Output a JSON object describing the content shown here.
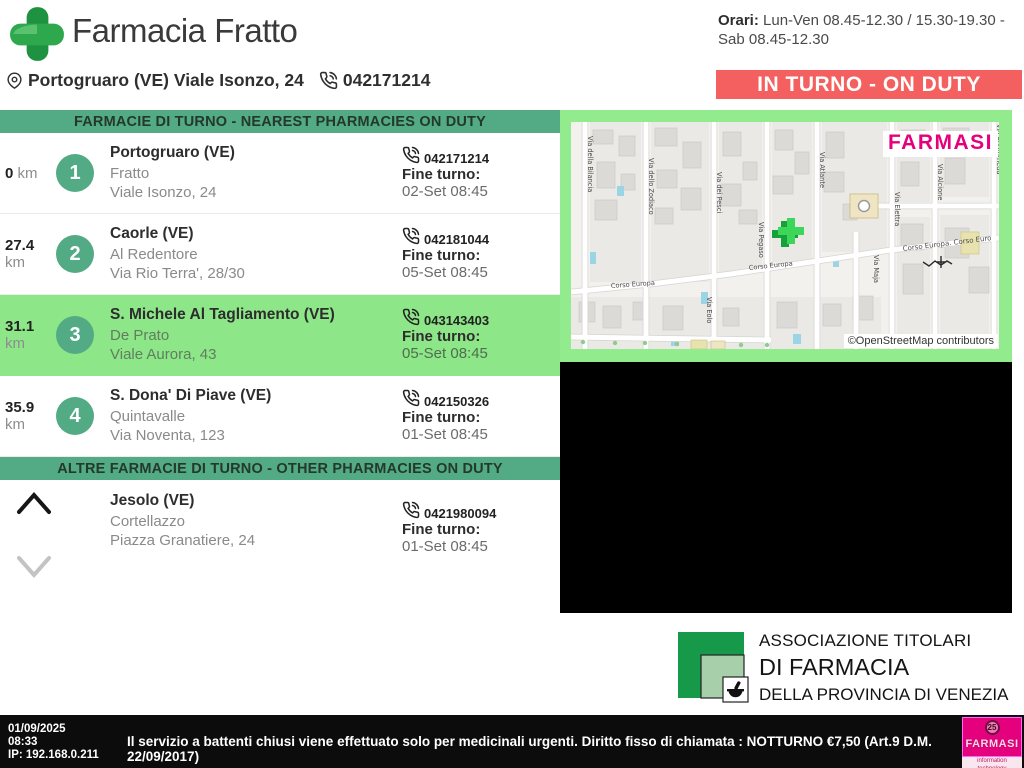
{
  "header": {
    "title": "Farmacia Fratto",
    "orari_label": "Orari:",
    "orari_text": " Lun-Ven 08.45-12.30 / 15.30-19.30 - Sab 08.45-12.30",
    "address": "Portogruaro (VE) Viale Isonzo, 24",
    "phone": "042171214",
    "duty_banner": "IN TURNO - ON DUTY"
  },
  "list": {
    "nearest_header": "FARMACIE DI TURNO - NEAREST PHARMACIES ON DUTY",
    "other_header": "ALTRE FARMACIE DI TURNO - OTHER PHARMACIES ON DUTY",
    "km_unit": "km",
    "fine_turno_label": "Fine turno:",
    "entries": [
      {
        "distance": "0",
        "number": "1",
        "city": "Portogruaro (VE)",
        "name": "Fratto",
        "address": "Viale Isonzo, 24",
        "phone": "042171214",
        "fine_turno": "02-Set 08:45",
        "highlighted": false
      },
      {
        "distance": "27.4",
        "number": "2",
        "city": "Caorle (VE)",
        "name": "Al Redentore",
        "address": "Via Rio Terra', 28/30",
        "phone": "042181044",
        "fine_turno": "05-Set 08:45",
        "highlighted": false
      },
      {
        "distance": "31.1",
        "number": "3",
        "city": "S. Michele Al Tagliamento (VE)",
        "name": "De Prato",
        "address": "Viale Aurora, 43",
        "phone": "043143403",
        "fine_turno": "05-Set 08:45",
        "highlighted": true
      },
      {
        "distance": "35.9",
        "number": "4",
        "city": "S. Dona' Di Piave (VE)",
        "name": "Quintavalle",
        "address": "Via Noventa, 123",
        "phone": "042150326",
        "fine_turno": "01-Set 08:45",
        "highlighted": false
      }
    ],
    "other_entries": [
      {
        "city": "Jesolo (VE)",
        "name": "Cortellazzo",
        "address": "Piazza Granatiere, 24",
        "phone": "0421980094",
        "fine_turno": "01-Set 08:45"
      }
    ]
  },
  "map": {
    "brand": "FARMASI",
    "attribution": "©OpenStreetMap contributors",
    "streets": {
      "bilancia": "Via della Bilancia",
      "zodiaco": "Via dello Zodiaco",
      "pesci": "Via dei Pesci",
      "atlante": "Via Atlante",
      "pegaso": "Via Pegaso",
      "eolo": "Via Eolo",
      "elettra": "Via Elettra",
      "maja": "Via Maja",
      "alcione": "Via Alcione",
      "andromeda": "Via Andromeda",
      "corso_left": "Corso Europa",
      "corso_mid": "Corso Europa",
      "corso_right": "Corso Europa. Corso Euro"
    }
  },
  "association": {
    "line1": "ASSOCIAZIONE TITOLARI",
    "line2": "DI FARMACIA",
    "line3": "DELLA PROVINCIA DI VENEZIA"
  },
  "footer": {
    "date": "01/09/2025",
    "time": "08:33",
    "ip": "IP: 192.168.0.211",
    "message": "Il servizio a battenti chiusi viene effettuato solo per medicinali urgenti. Diritto fisso di chiamata : NOTTURNO €7,50 (Art.9 D.M. 22/09/2017)",
    "farmasi_logo": "FARMASI",
    "farmasi_badge": "25",
    "farmasi_sub": "information technology"
  },
  "colors": {
    "accent_green": "#52ab84",
    "highlight_green": "#8de687",
    "map_border_green": "#92ec8e",
    "banner_red": "#f45f5f",
    "farmasi_magenta": "#e5007d",
    "logo_green_dark": "#1f9242",
    "logo_green_light": "#2da84c"
  }
}
